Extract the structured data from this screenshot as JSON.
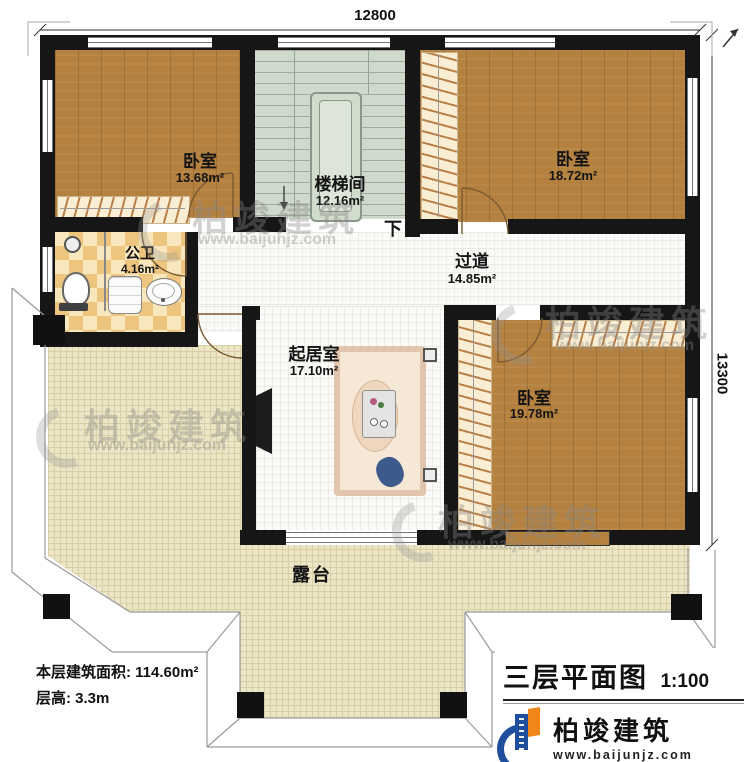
{
  "dimensions": {
    "top": "12800",
    "right": "13300"
  },
  "rooms": {
    "bedroom_nw": {
      "name": "卧室",
      "area": "13.68m²"
    },
    "stairwell": {
      "name": "楼梯间",
      "area": "12.16m²",
      "direction": "下"
    },
    "bedroom_ne": {
      "name": "卧室",
      "area": "18.72m²"
    },
    "bathroom": {
      "name": "公卫",
      "area": "4.16m²"
    },
    "corridor": {
      "name": "过道",
      "area": "14.85m²"
    },
    "living_room": {
      "name": "起居室",
      "area": "17.10m²"
    },
    "bedroom_se": {
      "name": "卧室",
      "area": "19.78m²"
    },
    "terrace": {
      "name": "露台"
    }
  },
  "notes": {
    "floor_area_label": "本层建筑面积:",
    "floor_area_value": "114.60m²",
    "floor_height_label": "层高:",
    "floor_height_value": "3.3m"
  },
  "title_block": {
    "title": "三层平面图",
    "scale": "1:100",
    "brand": "柏竣建筑",
    "website": "www.baijunjz.com"
  },
  "watermark": {
    "brand": "柏竣建筑",
    "website": "www.baijunjz.com"
  },
  "colors": {
    "wall": "#161616",
    "wood_floor": "#b5813f",
    "stair_floor": "#cfd9cc",
    "tile_light": "#f8e7bd",
    "tile_dark": "#eec57f",
    "terrace_floor": "#ece5c6",
    "mattress_blue": "#62b0cd",
    "nightstand_orange": "#e0764a",
    "sofa_salmon": "#e8a88a",
    "logo_blue": "#1f4e9c",
    "logo_orange": "#f08519"
  }
}
